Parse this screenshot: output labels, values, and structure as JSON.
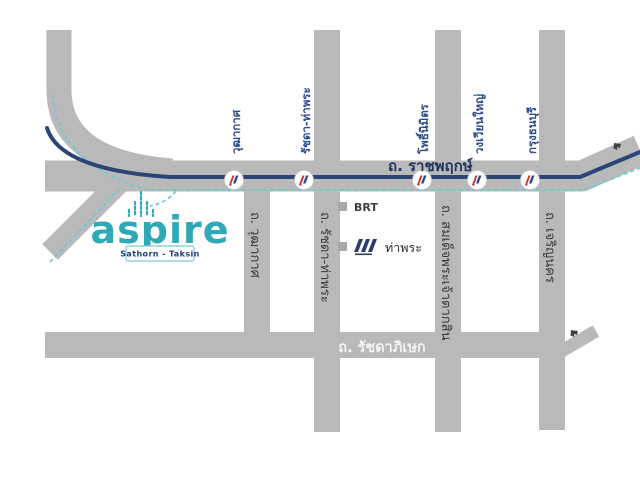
{
  "logo": {
    "brand": "aspire",
    "subtitle": "Sathorn - Taksin"
  },
  "main_road": {
    "label": "ถ. ราชพฤกษ์"
  },
  "bottom_road": {
    "label": "ถ. รัชดาภิเษก"
  },
  "vertical_roads": [
    {
      "label": "ถ. วุฒากาศ"
    },
    {
      "label": "ถ. รัชดา-ท่าพระ"
    },
    {
      "label": "ถ. สมเด็จพระเจ้าตากสิน"
    },
    {
      "label": "ถ. เจริญนคร"
    }
  ],
  "brt_stations": [
    {
      "name": "วุฒากาศ"
    },
    {
      "name": "รัชดา-ท่าพระ"
    },
    {
      "name": "โพธิ์นิมิตร"
    },
    {
      "name": "วงเวียนใหญ่"
    },
    {
      "name": "กรุงธนบุรี"
    }
  ],
  "legend": {
    "items": [
      {
        "label": "BRT"
      },
      {
        "label": "ท่าพระ"
      }
    ]
  },
  "colors": {
    "road": "#b9b9ba",
    "brt_line": "#2a4576",
    "future_dashed_line": "#6cc9d4",
    "station_label": "#2b4a8c",
    "main_road_label": "#1e3560",
    "bottom_road_label": "#f2f2f2",
    "brand": "#2fa9b5",
    "badge_text": "#1d3f7a",
    "badge_border": "#8ed3da"
  }
}
